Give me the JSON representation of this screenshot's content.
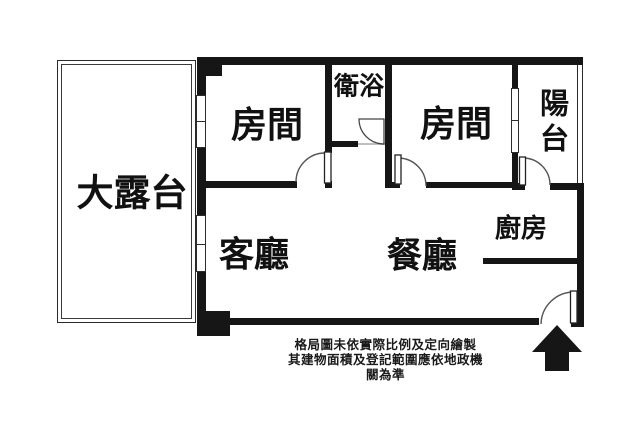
{
  "plan": {
    "rooms": {
      "terrace": {
        "label": "大露台"
      },
      "bedroom_1": {
        "label": "房間"
      },
      "bathroom": {
        "label": "衛浴"
      },
      "bedroom_2": {
        "label": "房間"
      },
      "balcony": {
        "label": "陽台"
      },
      "living_room": {
        "label": "客廳"
      },
      "dining_room": {
        "label": "餐廳"
      },
      "kitchen": {
        "label": "廚房"
      }
    },
    "disclaimer": {
      "line_1": "格局圖未依實際比例及定向繪製",
      "line_2": "其建物面積及登記範圍應依地政機關為準"
    },
    "icons": {
      "entrance_marker": "entrance-arrow-up"
    },
    "colors": {
      "wall": "#161616",
      "background": "#ffffff",
      "text": "#111111"
    }
  }
}
